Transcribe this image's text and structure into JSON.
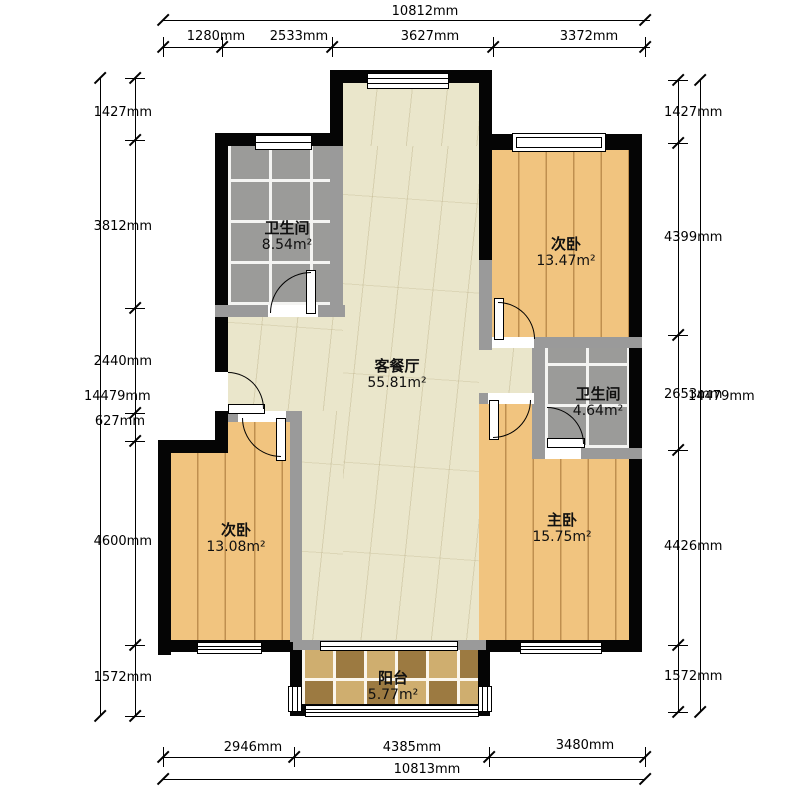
{
  "dims": {
    "top": {
      "total": "10812mm",
      "segments": [
        "1280mm",
        "2533mm",
        "3627mm",
        "3372mm"
      ]
    },
    "bottom": {
      "total": "10813mm",
      "segments": [
        "2946mm",
        "4385mm",
        "3480mm"
      ]
    },
    "left": {
      "total": "14479mm",
      "segments": [
        "1427mm",
        "3812mm",
        "2440mm",
        "627mm",
        "4600mm",
        "1572mm"
      ]
    },
    "right": {
      "total": "14479mm",
      "segments": [
        "1427mm",
        "4399mm",
        "2653mm",
        "4426mm",
        "1572mm"
      ]
    }
  },
  "rooms": {
    "bathroom_top": {
      "name": "卫生间",
      "area": "8.54m²"
    },
    "bedroom_top": {
      "name": "次卧",
      "area": "13.47m²"
    },
    "living": {
      "name": "客餐厅",
      "area": "55.81m²"
    },
    "bathroom_right": {
      "name": "卫生间",
      "area": "4.64m²"
    },
    "bedroom_left": {
      "name": "次卧",
      "area": "13.08m²"
    },
    "master": {
      "name": "主卧",
      "area": "15.75m²"
    },
    "balcony": {
      "name": "阳台",
      "area": "5.77m²"
    }
  },
  "colors": {
    "outer_wall": "#050505",
    "inner_wall": "#9a9a9a",
    "wood_floor": "#f1c47f",
    "tile_floor": "#9b9b99",
    "living_floor": "#eae6cb",
    "balcony_tile": "#c8a667"
  }
}
